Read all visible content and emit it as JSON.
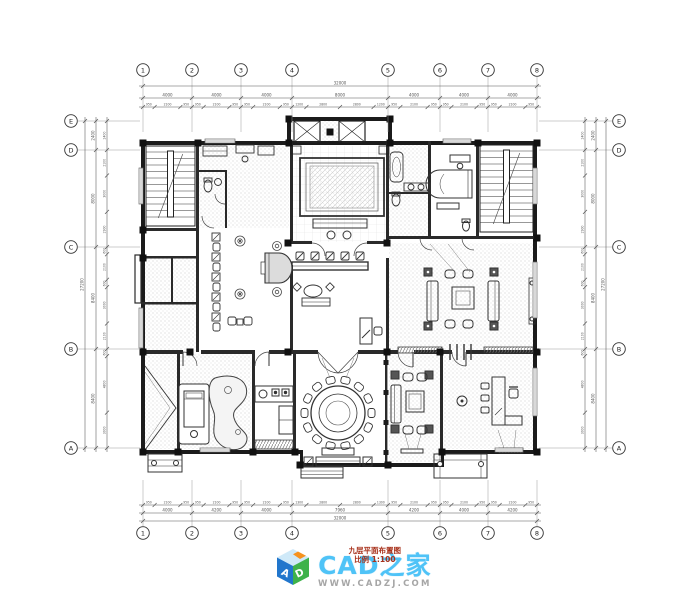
{
  "palette": {
    "line": "#1b1b1b",
    "dim": "#555555",
    "grid_label": "#222222",
    "ext_line": "#9a9a9a",
    "stipple": "#bdbdbd",
    "bg": "#ffffff"
  },
  "grid": {
    "top_labels": [
      "1",
      "2",
      "3",
      "4",
      "5",
      "6",
      "7",
      "8"
    ],
    "bottom_labels": [
      "1",
      "2",
      "3",
      "4",
      "5",
      "6",
      "7",
      "8"
    ],
    "left_labels": [
      "E",
      "D",
      "C",
      "B",
      "A"
    ],
    "right_labels": [
      "E",
      "D",
      "C",
      "B",
      "A"
    ]
  },
  "dimensions": {
    "top": {
      "total": "32000",
      "segments": [
        "4000",
        "4000",
        "4000",
        "8000",
        "4000",
        "4000",
        "4000"
      ],
      "details": [
        "950",
        "2100",
        "950",
        "950",
        "2100",
        "950",
        "950",
        "2100",
        "950",
        "1200",
        "2800",
        "2800",
        "1200",
        "950",
        "2100",
        "950",
        "950",
        "2100",
        "950",
        "950",
        "2100",
        "950"
      ]
    },
    "bottom": {
      "total": "32000",
      "segments": [
        "4000",
        "4200",
        "4000",
        "7960",
        "4200",
        "4000",
        "4200"
      ],
      "details": [
        "950",
        "2100",
        "950",
        "950",
        "2100",
        "950",
        "950",
        "2100",
        "950",
        "1300",
        "2800",
        "2800",
        "1300",
        "950",
        "2100",
        "950",
        "950",
        "2100",
        "950",
        "950",
        "2100",
        "950"
      ]
    },
    "left": {
      "total": "27200",
      "segments": [
        "2400",
        "8000",
        "8400",
        "8400"
      ],
      "details": [
        "2400",
        "2100",
        "3000",
        "2900",
        "600",
        "2100",
        "600",
        "3000",
        "2100",
        "600",
        "4800",
        "3000"
      ]
    },
    "right": {
      "total": "27200",
      "segments": [
        "2400",
        "8000",
        "8400",
        "8400"
      ],
      "details": [
        "2400",
        "2100",
        "3000",
        "2900",
        "600",
        "2100",
        "600",
        "3000",
        "2100",
        "600",
        "4800",
        "3000"
      ]
    }
  },
  "logo": {
    "brand": "CAD之家",
    "website": "WWW.CADZJ.COM",
    "stamp_line1": "九层平面布置图",
    "stamp_line2": "比例 1:100",
    "cube_letter_left": "A",
    "cube_letter_right": "D",
    "brand_color": "#4fc3f7",
    "website_color": "#a6a6a6",
    "stamp_color": "#a8321c",
    "cube_left_color": "#2176cc",
    "cube_right_color": "#3eb24a",
    "cube_top_color": "#cfe9f8",
    "cube_accent_color": "#f6921e"
  }
}
